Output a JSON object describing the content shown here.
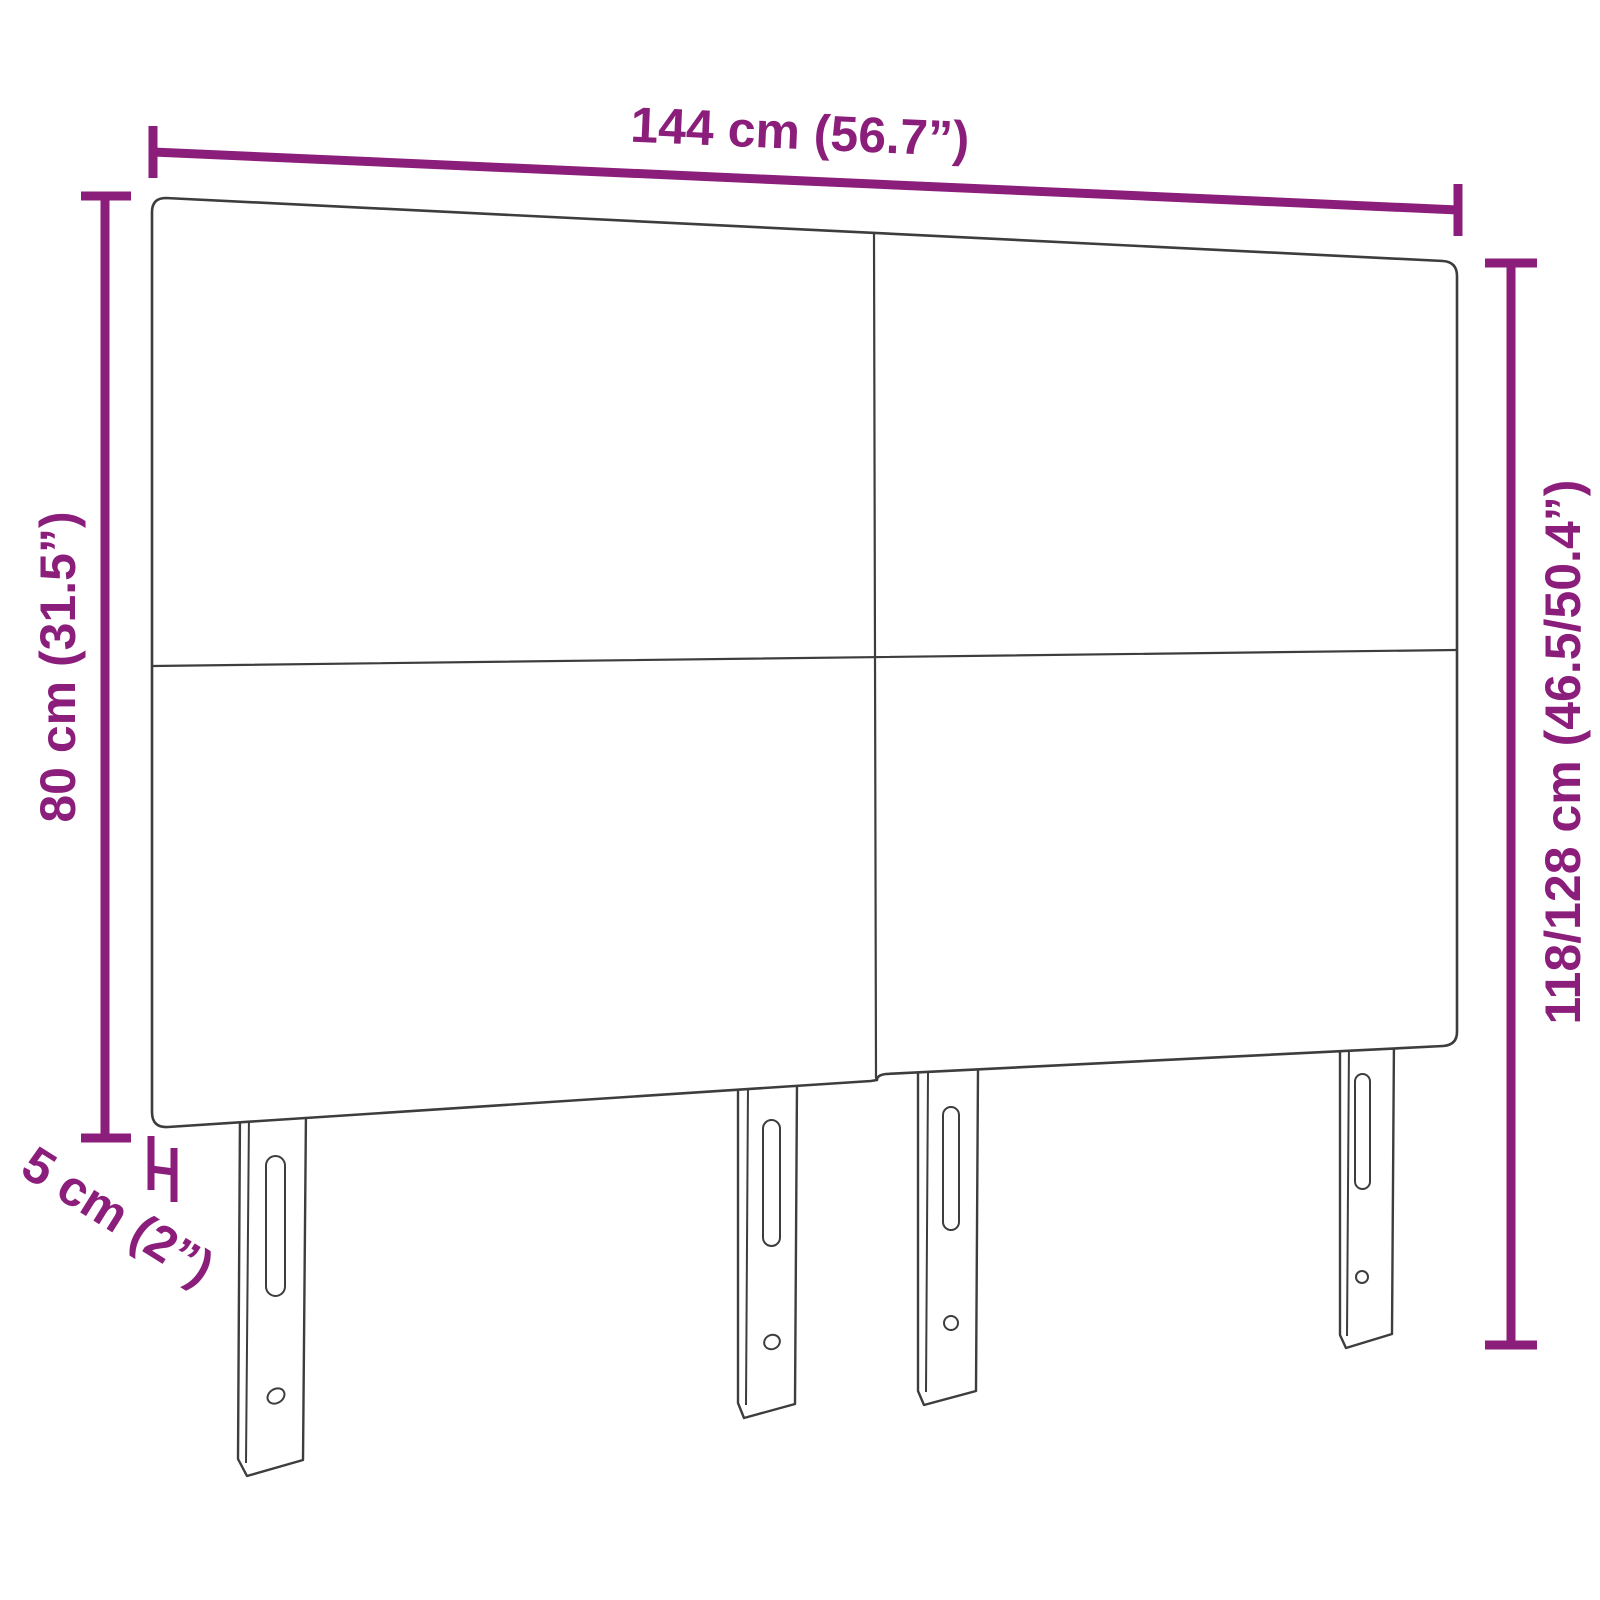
{
  "colors": {
    "accent": "#8b1d7b",
    "outline": "#3d3d3d",
    "background": "#ffffff"
  },
  "dimensions": {
    "width_label": "144 cm (56.7”)",
    "panel_height_label": "80 cm (31.5”)",
    "total_height_label": "118/128 cm (46.5/50.4”)",
    "depth_label": "5 cm (2”)"
  }
}
